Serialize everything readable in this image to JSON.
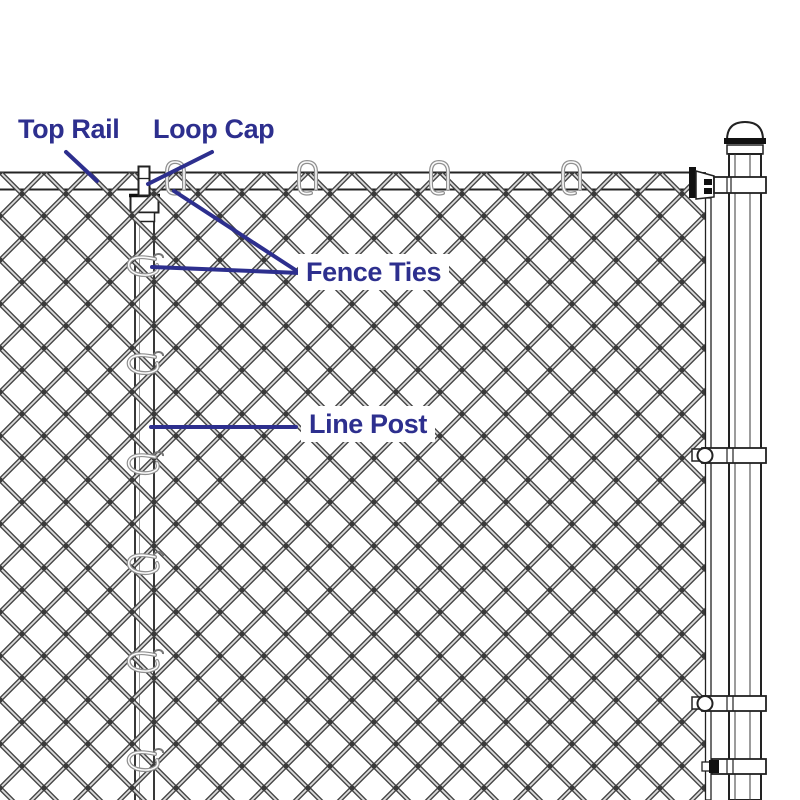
{
  "labels": {
    "top_rail": "Top Rail",
    "loop_cap": "Loop Cap",
    "fence_ties": "Fence Ties",
    "line_post": "Line Post"
  },
  "colors": {
    "label_text": "#2d2f8e",
    "leader_line": "#2d2f8e",
    "wire_dark": "#454545",
    "wire_highlight": "#dcdcdc",
    "hardware_outline": "#222222",
    "tie_wire": "#8f8f8f",
    "background": "#ffffff"
  }
}
